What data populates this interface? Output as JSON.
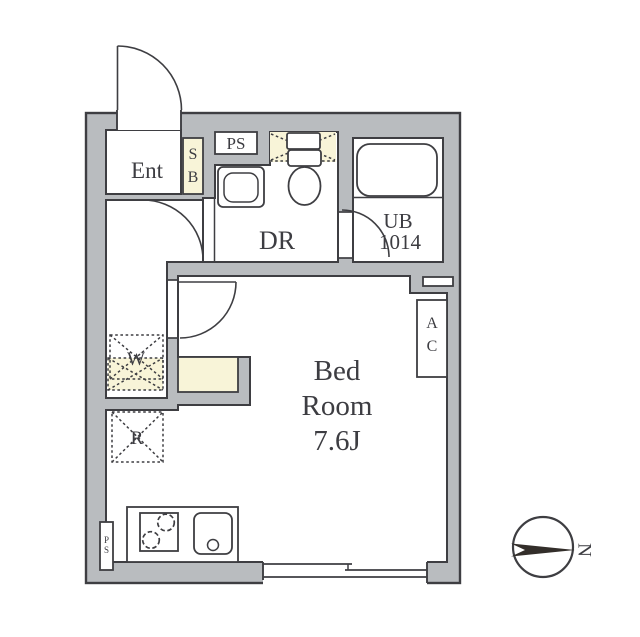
{
  "title": "apartment-floor-plan",
  "rooms": {
    "entrance": {
      "label": "Ent"
    },
    "shoe_box": {
      "line1": "S",
      "line2": "B"
    },
    "pipe_space_upper": {
      "label": "PS"
    },
    "toilet_room": {
      "label": "DR"
    },
    "unit_bath": {
      "line1": "UB",
      "line2": "1014"
    },
    "bedroom": {
      "line1": "Bed",
      "line2": "Room",
      "line3": "7.6J"
    },
    "washer_space": {
      "label": "W"
    },
    "refrigerator_space": {
      "label": "R"
    },
    "air_conditioner": {
      "line1": "A",
      "line2": "C"
    },
    "pipe_space_lower": {
      "line1": "P",
      "line2": "S"
    }
  },
  "compass": {
    "north_label": "N"
  },
  "colors": {
    "wall_fill": "#b9bcbf",
    "outline": "#3e3e42",
    "fixture_cream": "#f8f4d8",
    "floor_white": "#ffffff"
  }
}
